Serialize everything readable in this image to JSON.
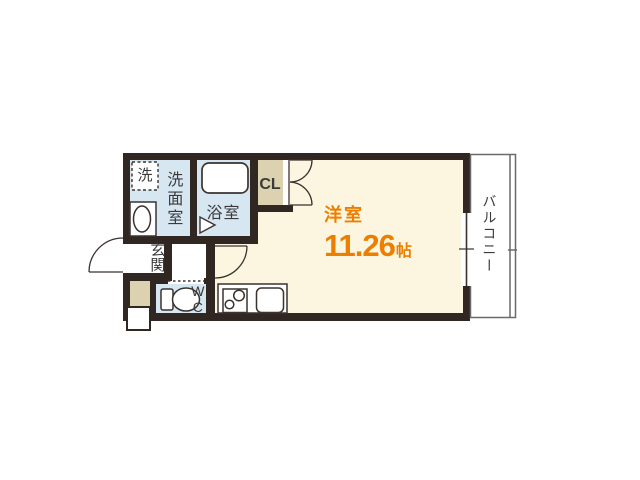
{
  "rooms": {
    "washroom": {
      "label": "洗面室"
    },
    "washer": {
      "label": "洗"
    },
    "bathroom": {
      "label": "浴室"
    },
    "closet": {
      "label": "CL"
    },
    "entrance": {
      "label": "玄関"
    },
    "wc": {
      "label": "WC"
    },
    "main_room": {
      "label": "洋室",
      "area_value": "11.26",
      "area_unit": "帖"
    },
    "balcony": {
      "label": "バルコニー"
    }
  },
  "fixtures": [
    "washing-machine",
    "vanity-sink",
    "bathtub",
    "toilet",
    "gas-stove",
    "kitchen-sink",
    "kitchen-counter",
    "sliding-window",
    "entrance-door",
    "hall-door",
    "closet-double-door",
    "meter-box"
  ],
  "colors": {
    "wall": "#302722",
    "wet_area_blue": "#d7e7f2",
    "living_cream": "#fcf5df",
    "closet_beige": "#dcd2b0",
    "accent_orange": "#ed7f00",
    "balcony_line_gray": "#6a6a6a",
    "text_dark": "#3a3a3a"
  }
}
